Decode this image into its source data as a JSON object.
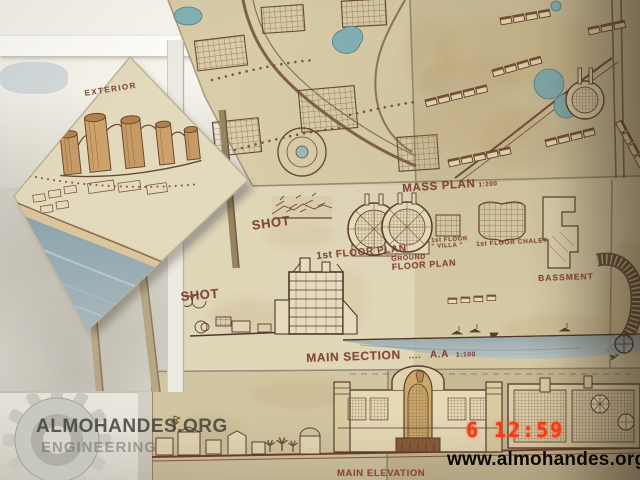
{
  "scene": {
    "description": "Photograph of architectural presentation boards of a seaside resort project displayed on a wall, with a diamond-mounted exterior perspective board on an easel",
    "timestamp": "6 12:59",
    "website": "www.almohandes.org",
    "watermark": {
      "line1": "ALMOHANDES.ORG",
      "line2": "ENGINEERING",
      "icon": "gear-icon"
    }
  },
  "board_labels": {
    "exterior": "EXTERIOR",
    "shot_upper": "SHOT",
    "shot_lower": "SHOT",
    "mass_plan": "MASS PLAN",
    "mass_plan_scale": "1:200",
    "first_floor_plan": "1st FLOOR PLAN",
    "ground_floor_l1": "GROUND",
    "ground_floor_l2": "FLOOR PLAN",
    "villa_l1": "1st FLOOR",
    "villa_l2": "\" VILLA \"",
    "chalet": "1st FLOOR CHALET.",
    "basement": "BASSMENT",
    "main_section": "MAIN SECTION",
    "main_section_dots": "....",
    "main_section_ref": "A.A",
    "main_section_scale": "1:100",
    "main_elevation": "MAIN ELEVATION"
  },
  "colors": {
    "board_paper": "#d9cda9",
    "ink_brown": "#6b4a36",
    "label_maroon": "#7b3a2e",
    "pool_teal": "#84b2b6",
    "sea_blue": "#8ba2ac",
    "timestamp_red": "#f23920",
    "website_black": "#0b0906",
    "watermark_grey": "#46463e"
  }
}
